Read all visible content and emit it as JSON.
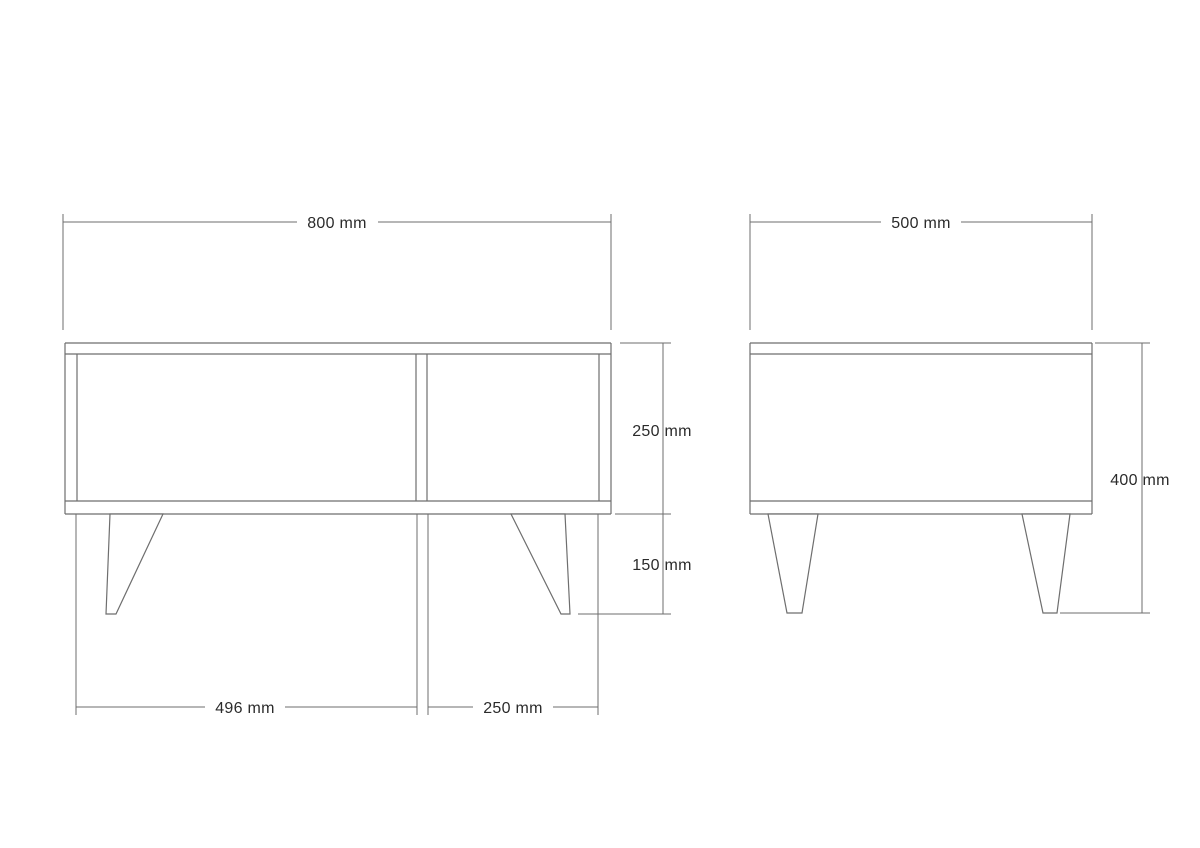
{
  "colors": {
    "line": "#6e6e6e",
    "text": "#2b2b2b",
    "background": "#ffffff"
  },
  "front": {
    "labels": {
      "overall_width": "800 mm",
      "body_height": "250 mm",
      "leg_height": "150 mm",
      "left_compartment_width": "496 mm",
      "right_compartment_width": "250 mm"
    }
  },
  "side": {
    "labels": {
      "overall_depth": "500 mm",
      "overall_height": "400 mm"
    }
  }
}
